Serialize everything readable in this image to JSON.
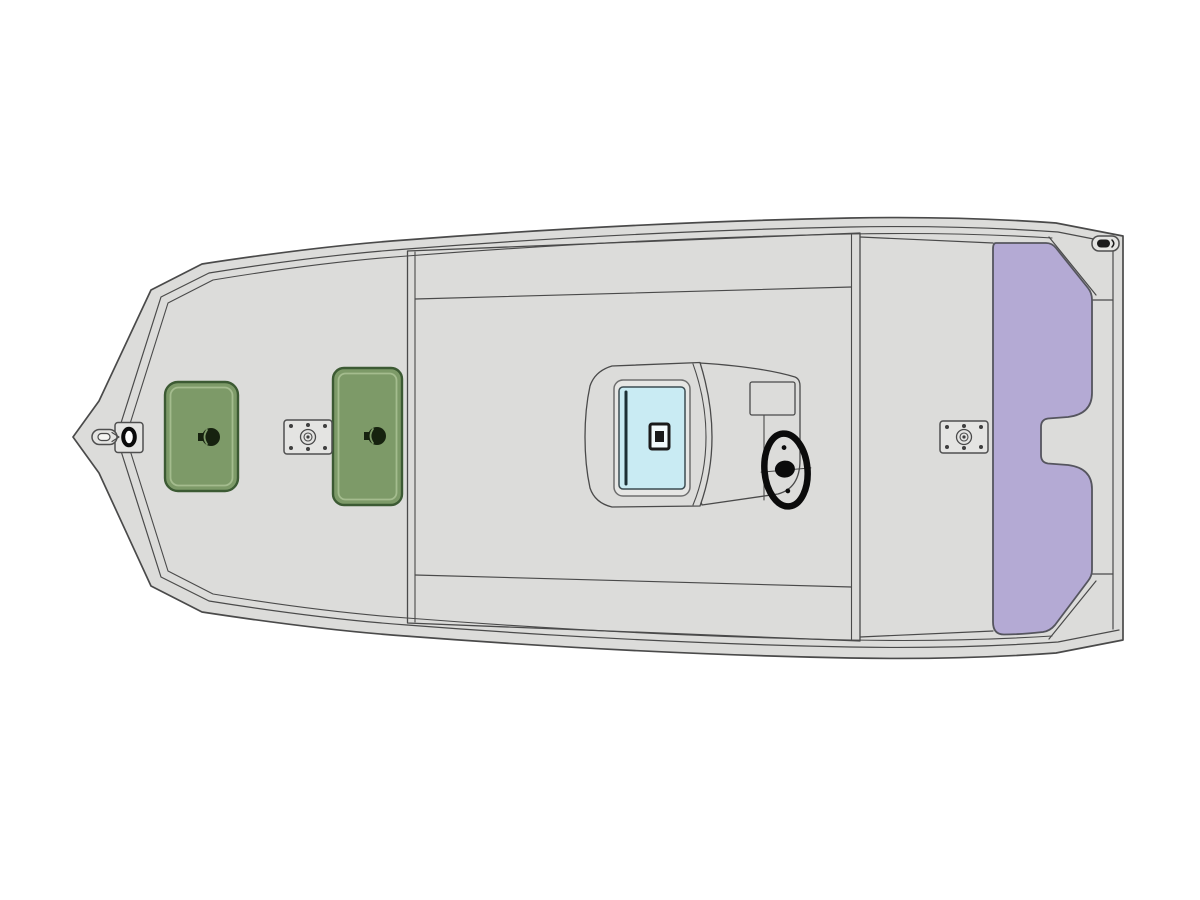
{
  "diagram": {
    "kind": "boat-floorplan-top-view",
    "colors": {
      "background": "#ffffff",
      "deck": "#dcdcda",
      "outline": "#4a4a4a",
      "outline_soft": "#6e6e6e",
      "aft_deck_purple": "#b4aad4",
      "purple_edge": "#55555e",
      "hatch_green": "#7d9a68",
      "hatch_green_edge": "#3c5a33",
      "hatch_green_highlight": "#a4bc8e",
      "latch_dark": "#16220f",
      "console_window_blue": "#c9ebf3",
      "console_window_edge": "#3c4c52",
      "console_frame": "#e6e6e4",
      "hinge_dark": "#1d3036",
      "wheel_black": "#0b0b0b",
      "hardware_fill": "#e4e4e2",
      "hardware_edge": "#4f4f4f",
      "bolt": "#3f3f3f",
      "latch_face": "#f2fafc",
      "latch_edge": "#1a1a1a"
    },
    "parts": {
      "hull": "aluminum hull outline",
      "bow_deck": "bow casting deck",
      "bow_light_base": "bow light base plate",
      "bow_cleat": "bow pull capsule",
      "bow_hatch": "bow storage hatch (green)",
      "mid_hatch": "mid storage hatch (green)",
      "pedestal_base_front": "front pedestal seat base",
      "pedestal_base_rear": "rear pedestal seat base",
      "cockpit_floor": "cockpit floor liner",
      "console": "center console",
      "console_hatch": "console access hatch (blue)",
      "steering_wheel": "steering wheel",
      "aft_deck": "aft deck (purple)",
      "splash_well": "splash well cutout",
      "stern_cleat": "stern cleat",
      "transom": "transom"
    }
  }
}
